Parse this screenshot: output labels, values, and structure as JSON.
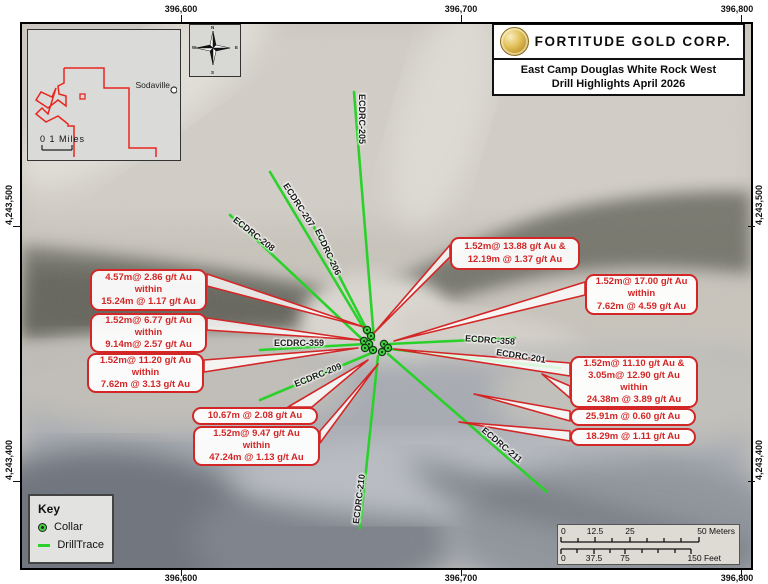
{
  "title": {
    "company": "FORTITUDE GOLD CORP.",
    "line1": "East Camp Douglas White Rock West",
    "line2": "Drill Highlights April 2026"
  },
  "coords": {
    "top": [
      "396,600",
      "396,700",
      "396,800"
    ],
    "bottom": [
      "396,600",
      "396,700",
      "396,800"
    ],
    "left": [
      "4,243,500",
      "4,243,400"
    ],
    "right": [
      "4,243,500",
      "4,243,400"
    ]
  },
  "inset": {
    "town": "Sodaville",
    "scale_label": "0    1 Miles"
  },
  "compass": {
    "n": "N",
    "e": "E",
    "s": "S",
    "w": "W"
  },
  "key": {
    "heading": "Key",
    "collar": "Collar",
    "drilltrace": "DrillTrace"
  },
  "scalebar": {
    "meters": [
      "0",
      "12.5",
      "25",
      "50 Meters"
    ],
    "feet": [
      "0",
      "37.5",
      "75",
      "150 Feet"
    ]
  },
  "trace_labels": [
    "ECDRC-205",
    "ECDRC-206",
    "ECDRC-207",
    "ECDRC-208",
    "ECDRC-359",
    "ECDRC-209",
    "ECDRC-358",
    "ECDRC-201",
    "ECDRC-210",
    "ECDRC-211"
  ],
  "annotations": [
    {
      "lines": [
        "4.57m@ 2.86 g/t Au",
        "within",
        "15.24m @ 1.17 g/t Au"
      ]
    },
    {
      "lines": [
        "1.52m@ 6.77 g/t Au",
        "within",
        "9.14m@ 2.57 g/t Au"
      ]
    },
    {
      "lines": [
        "1.52m@ 11.20 g/t Au",
        "within",
        "7.62m @ 3.13 g/t Au"
      ]
    },
    {
      "lines": [
        "10.67m @ 2.08 g/t Au"
      ]
    },
    {
      "lines": [
        "1.52m@ 9.47 g/t Au",
        "within",
        "47.24m @ 1.13 g/t Au"
      ]
    },
    {
      "lines": [
        "1.52m@ 13.88 g/t Au &",
        "12.19m @ 1.37 g/t Au"
      ]
    },
    {
      "lines": [
        "1.52m@ 17.00 g/t Au",
        "within",
        "7.62m @ 4.59 g/t Au"
      ]
    },
    {
      "lines": [
        "1.52m@ 11.10 g/t Au &",
        "3.05m@ 12.90 g/t Au",
        "within",
        "24.38m @ 3.89 g/t Au"
      ]
    },
    {
      "lines": [
        "25.91m @ 0.60 g/t Au"
      ]
    },
    {
      "lines": [
        "18.29m @ 1.11 g/t Au"
      ]
    }
  ],
  "colors": {
    "trace_green": "#2bd12b",
    "annotation_red": "#d32727",
    "claim_red": "#e8261f",
    "collar_green": "#3fd03f"
  }
}
